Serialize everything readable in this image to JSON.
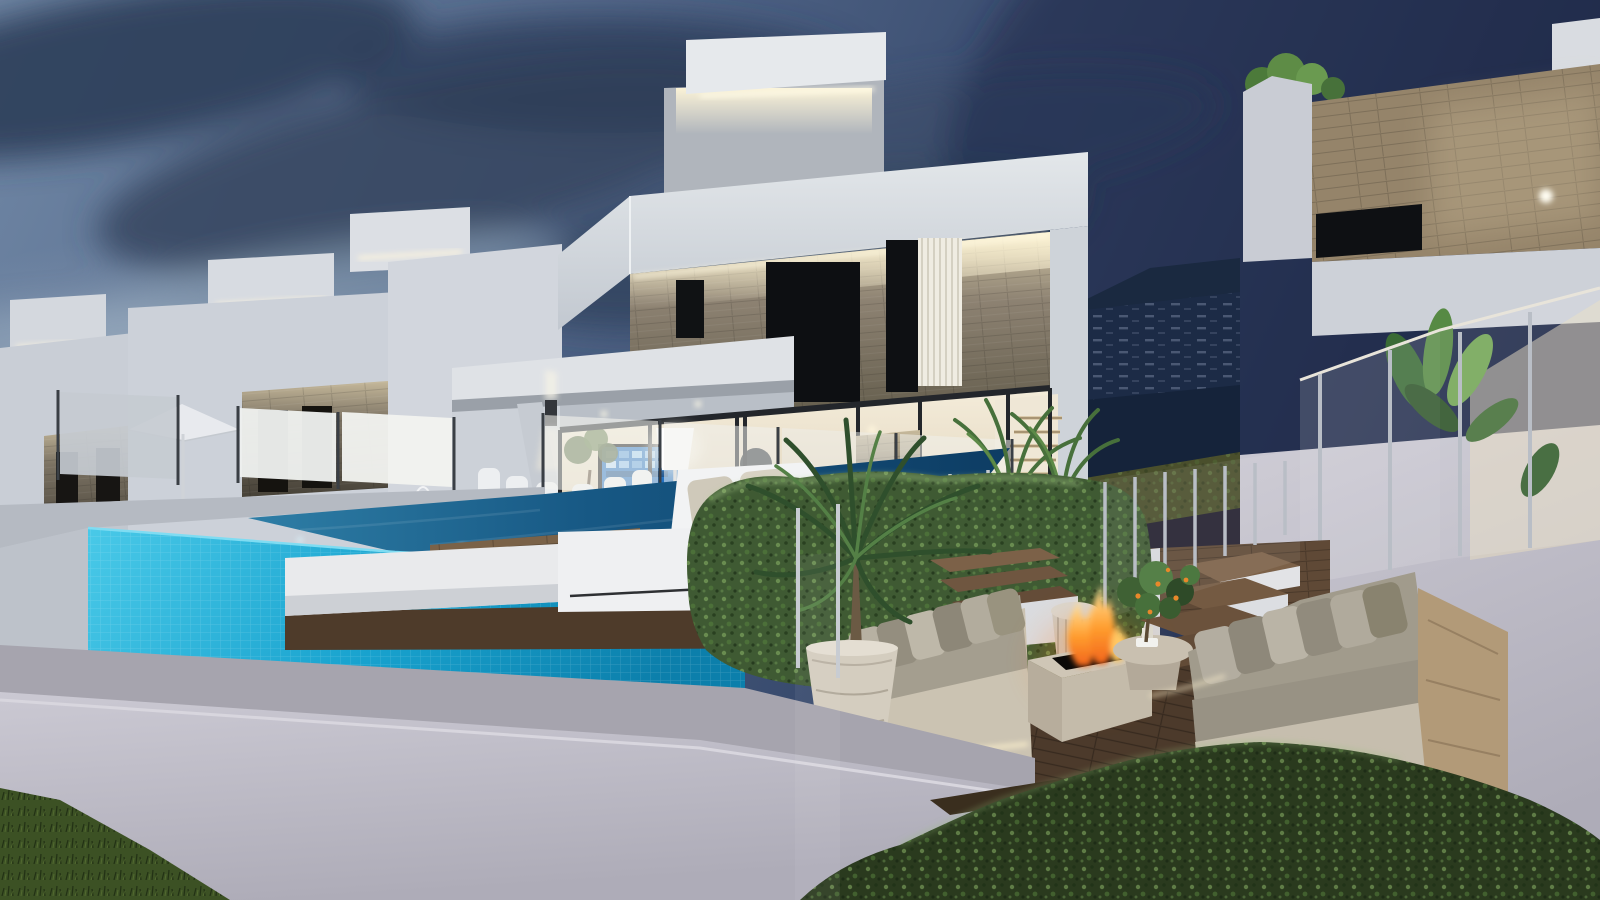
{
  "scene": {
    "type": "3d-architectural-rendering",
    "time_of_day": "dusk",
    "subject": "Modern white villas at dusk with infinity pool, wooden deck, outdoor lounge and fire pit",
    "objects": [
      "row of white modern villas with rooftop boxes and LED cove lighting",
      "main two-storey villa with stone accent facade and glazed ground floor",
      "interior with wall TV, floor lamp, dining chairs and staircase",
      "right villa with wood-clad band and glass balcony with banana plants",
      "mountain hillside with terraced buildings in background gap",
      "turquoise tiled infinity pool with dark water surface and underwater lights",
      "glass pool fence with steel posts",
      "white parasol and lanterns on neighbouring terrace",
      "white daybed loungers on wooden deck",
      "boxwood hedge cube and foreground hedge row",
      "outdoor lounge: two taupe sofas with cushions, travertine fire pit with flames",
      "wicker side table, round coffee table, citrus tree with oranges",
      "potted palms in white ribbed planters",
      "white perimeter wall and grass in foreground",
      "two birds in the sky"
    ]
  },
  "palette": {
    "sky_left": "#6f86a4",
    "sky_right": "#232f4f",
    "cloud_dark": "#31425d",
    "cloud_light": "#9cb0c2",
    "villa_white": "#dfe3e7",
    "stone_accent": "#8d8272",
    "led_warm": "#fff6d8",
    "pool_tile": "#2bbce2",
    "pool_water": "#14527e",
    "deck_wood": "#6b543c",
    "lounge_floor": "#4c3a2b",
    "hedge_green": "#3f5a33",
    "sofa_fabric": "#a19b8c",
    "fire_orange": "#ff8a1f",
    "grass": "#3c5124",
    "glass_panel": "#f2f2ee",
    "wall_foreground": "#c4c2cb",
    "mountain_night": "#1a2940",
    "tv_screen_blue": "#1f6fc0"
  }
}
